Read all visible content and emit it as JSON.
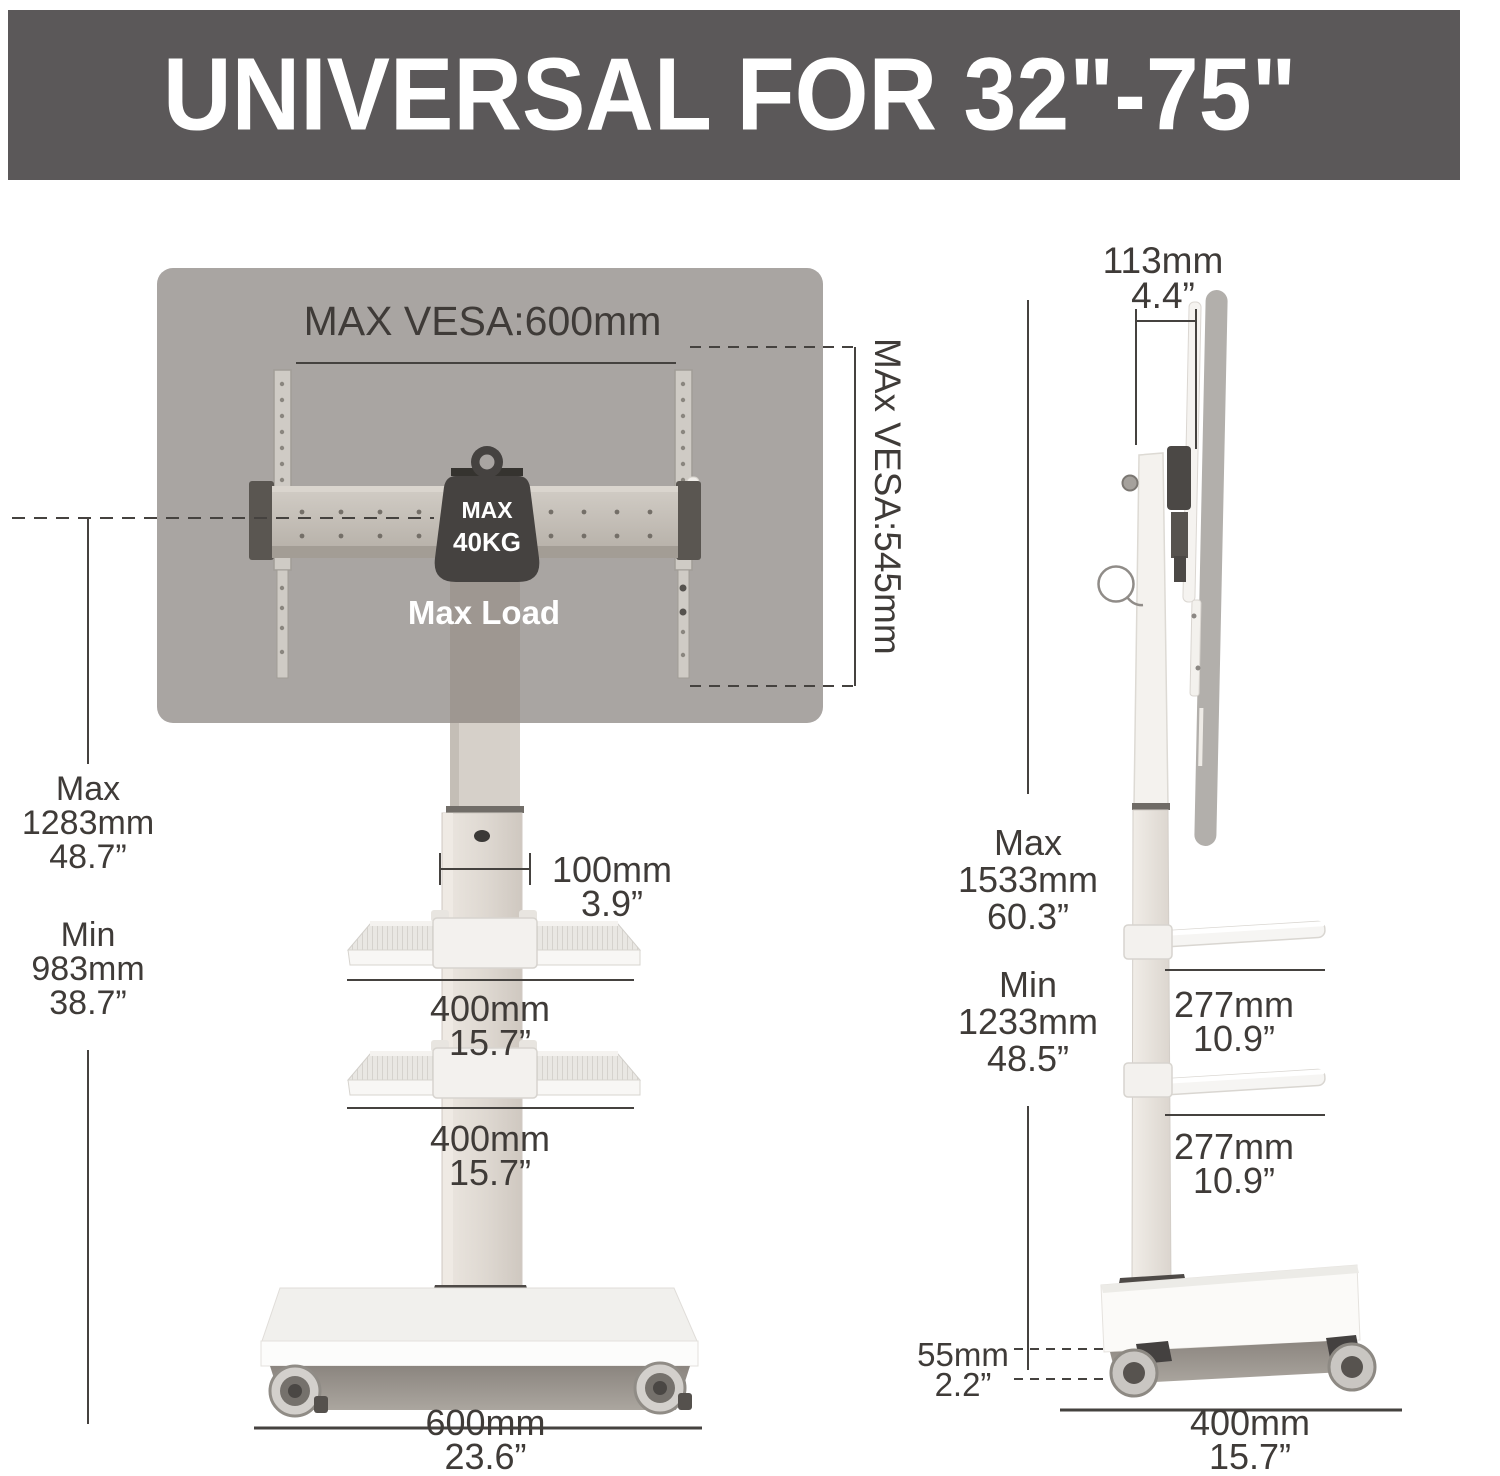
{
  "banner": {
    "title": "UNIVERSAL FOR 32\"-75\""
  },
  "front_view": {
    "max_vesa_width": "MAX VESA:600mm",
    "max_vesa_height": "MAx VESA:545mm",
    "weight_badge": {
      "line1": "MAX",
      "line2": "40KG"
    },
    "max_load_label": "Max Load",
    "height_max": {
      "label": "Max",
      "mm": "1283mm",
      "inch": "48.7”"
    },
    "height_min": {
      "label": "Min",
      "mm": "983mm",
      "inch": "38.7”"
    },
    "pole_width": {
      "mm": "100mm",
      "inch": "3.9”"
    },
    "shelf_upper": {
      "mm": "400mm",
      "inch": "15.7”"
    },
    "shelf_lower": {
      "mm": "400mm",
      "inch": "15.7”"
    },
    "base_width": {
      "mm": "600mm",
      "inch": "23.6”"
    }
  },
  "side_view": {
    "depth_top": {
      "mm": "113mm",
      "inch": "4.4”"
    },
    "height_max": {
      "label": "Max",
      "mm": "1533mm",
      "inch": "60.3”"
    },
    "height_min": {
      "label": "Min",
      "mm": "1233mm",
      "inch": "48.5”"
    },
    "shelf_upper": {
      "mm": "277mm",
      "inch": "10.9”"
    },
    "shelf_lower": {
      "mm": "277mm",
      "inch": "10.9”"
    },
    "caster_height": {
      "mm": "55mm",
      "inch": "2.2”"
    },
    "base_depth": {
      "mm": "400mm",
      "inch": "15.7”"
    }
  },
  "colors": {
    "banner_bg": "#5b5859",
    "banner_text": "#ffffff",
    "tv_panel": "#a9a5a2",
    "dimension_text": "#3f3b38",
    "weight_badge": "#454240",
    "stand_white": "#f3f1ee"
  }
}
